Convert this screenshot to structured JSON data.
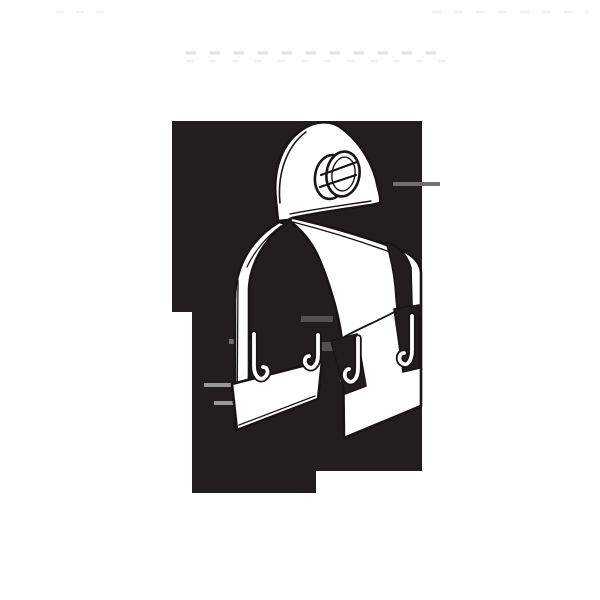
{
  "meta": {
    "description": "Black-and-white catalog line illustration of a two-piece steel strut-channel pipe clamp, viewed in perspective: an arched top tab with a slotted pan-head screw, two interlocking U-shaped clamp halves with hooked feet, drawn white with dark outlines over an irregular stepped black backdrop. No visible text.",
    "subject": "strut-pipe-clamp-illustration"
  },
  "colors": {
    "page_background": "#ffffff",
    "backdrop": "#221e1f",
    "line": "#191516",
    "fill": "#ffffff",
    "artifact_dark": "#55504f",
    "artifact_mid": "#6f6f6f",
    "artifact_light": "#9a9a9a",
    "artifact_faint": "#dedede",
    "artifact_fainter": "#ededed"
  }
}
